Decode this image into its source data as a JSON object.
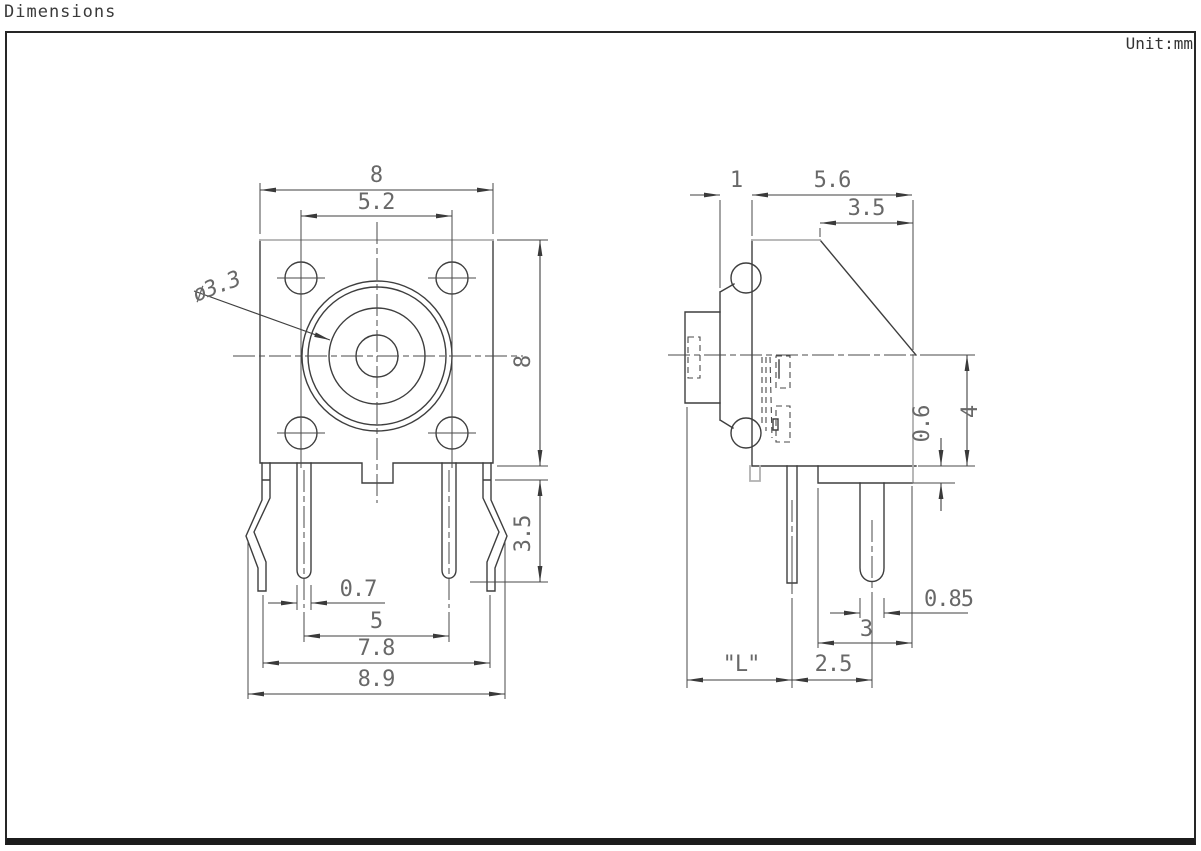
{
  "title": "Dimensions",
  "unit_label": "Unit:mm",
  "views": {
    "front": {
      "dims": {
        "body_width": "8",
        "hole_spacing": "5.2",
        "button_diameter": "ø3.3",
        "body_height": "8",
        "pin_exposed_length": "3.5",
        "pin_width": "0.7",
        "pin_pitch": "5",
        "leg_span": "7.8",
        "overall_width": "8.9"
      }
    },
    "side": {
      "dims": {
        "bezel_thickness": "1",
        "body_depth": "5.6",
        "chamfer_depth": "3.5",
        "step_height": "0.6",
        "lower_body_height": "4",
        "pin_diameter": "0.85",
        "step_depth": "3",
        "pin_setback": "2.5",
        "stem_length": "\"L\""
      }
    }
  }
}
